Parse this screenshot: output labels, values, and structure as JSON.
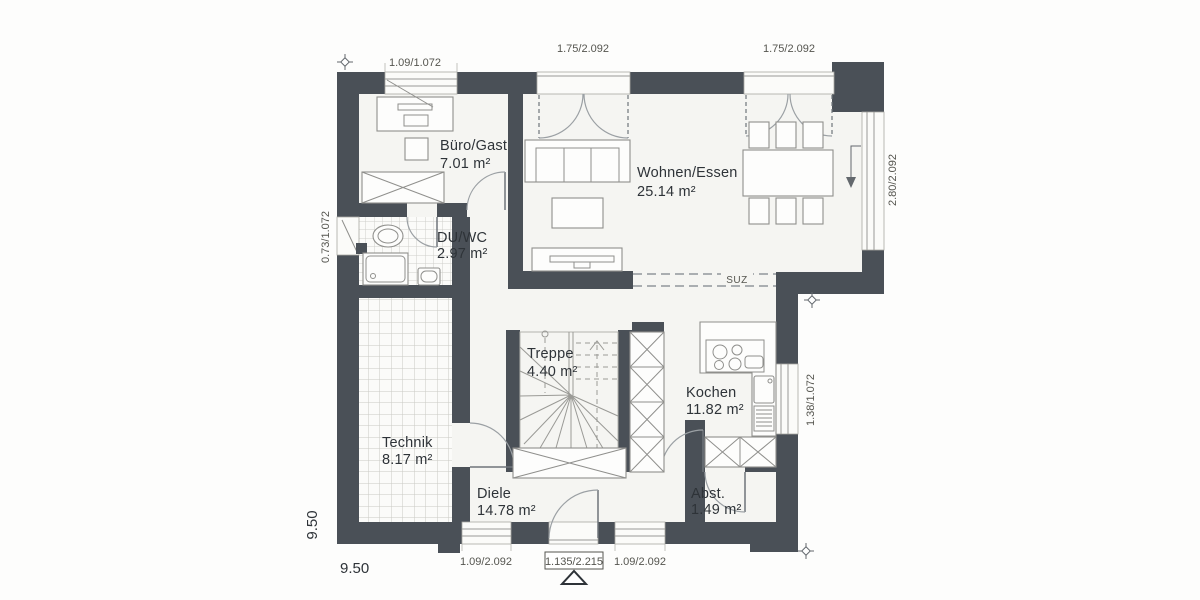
{
  "plan": {
    "rooms": {
      "buero": {
        "name": "Büro/Gast",
        "area": "7.01 m²"
      },
      "wohnen": {
        "name": "Wohnen/Essen",
        "area": "25.14 m²"
      },
      "duwc": {
        "name": "DU/WC",
        "area": "2.97 m²"
      },
      "treppe": {
        "name": "Treppe",
        "area": "4.40 m²"
      },
      "kochen": {
        "name": "Kochen",
        "area": "11.82 m²"
      },
      "technik": {
        "name": "Technik",
        "area": "8.17 m²"
      },
      "diele": {
        "name": "Diele",
        "area": "14.78 m²"
      },
      "abst": {
        "name": "Abst.",
        "area": "1.49 m²"
      }
    },
    "dims": {
      "top_window": "1.09/1.072",
      "top_door_left": "1.75/2.092",
      "top_door_right": "1.75/2.092",
      "right_window": "2.80/2.092",
      "left_window": "0.73/1.072",
      "kitchen_window": "1.38/1.072",
      "bottom_window_left": "1.09/2.092",
      "entry_door": "1.135/2.215",
      "bottom_window_right": "1.09/2.092",
      "total_width": "9.50",
      "total_depth": "9.50"
    },
    "annotations": {
      "lintel": "SUZ"
    },
    "colors": {
      "wall": "#4a5057",
      "floor": "#f5f5f2",
      "line": "#8f8f8c",
      "text": "#2e3338",
      "dim": "#55554f"
    }
  }
}
